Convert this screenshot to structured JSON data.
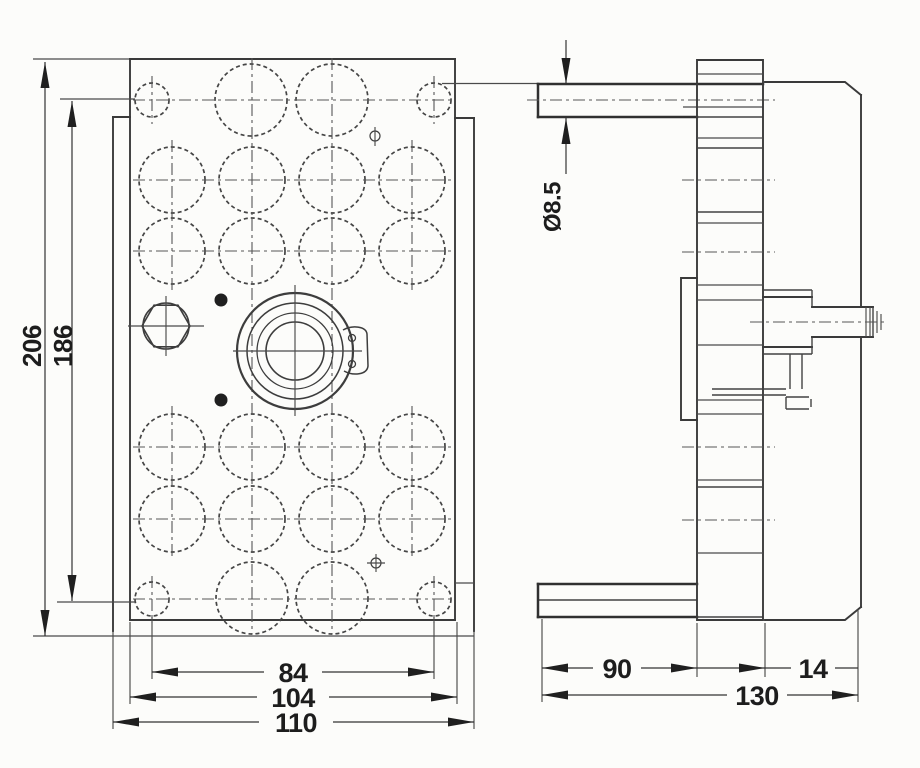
{
  "drawing": {
    "colors": {
      "background": "#fcfcfa",
      "line": "#3a3a3a",
      "text": "#1d1d1d"
    },
    "front_view": {
      "dim_overall_height": "206",
      "dim_hole_spacing_vertical": "186",
      "dim_hole_spacing_horizontal": "84",
      "dim_plate_width": "104",
      "dim_overall_width": "110"
    },
    "side_view": {
      "dim_hole_diameter": "Ø8.5",
      "dim_port_depth": "90",
      "dim_overall_depth": "130",
      "dim_rear_depth": "14"
    }
  }
}
